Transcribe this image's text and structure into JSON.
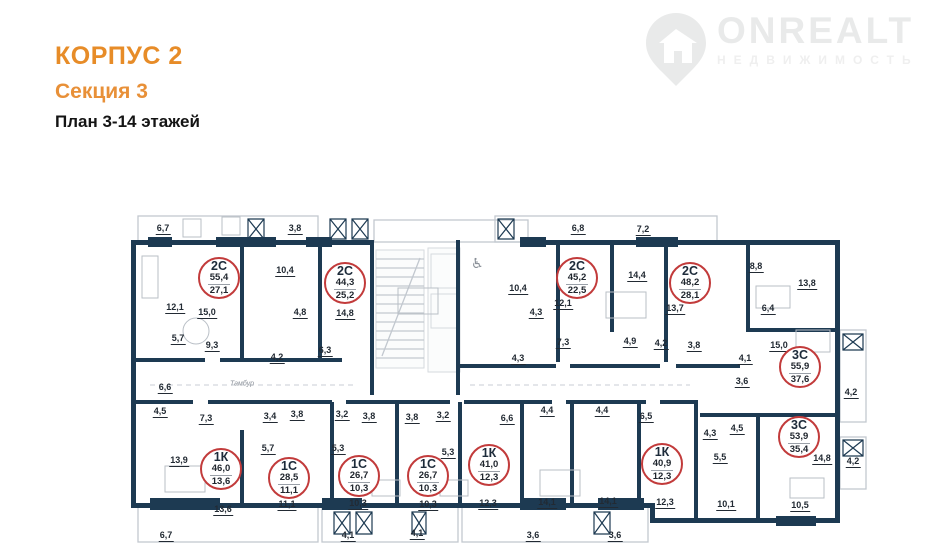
{
  "header": {
    "building": "КОРПУС 2",
    "section": "Секция 3",
    "plan": "План 3-14 этажей"
  },
  "logo": {
    "brand": "ONREALT",
    "tagline": "НЕДВИЖИМОСТЬ"
  },
  "colors": {
    "accent_orange": "#E78C28",
    "wall_navy": "#1D3A52",
    "unit_circle_red": "#C23B3B",
    "watermark_gray": "#E9EAEA"
  },
  "floor_plan": {
    "apartments": [
      {
        "type": "2С",
        "total": "55,4",
        "living": "27,1",
        "x": 219,
        "y": 278
      },
      {
        "type": "2С",
        "total": "44,3",
        "living": "25,2",
        "x": 345,
        "y": 283
      },
      {
        "type": "2С",
        "total": "45,2",
        "living": "22,5",
        "x": 577,
        "y": 278
      },
      {
        "type": "2С",
        "total": "48,2",
        "living": "28,1",
        "x": 690,
        "y": 283
      },
      {
        "type": "3С",
        "total": "55,9",
        "living": "37,6",
        "x": 800,
        "y": 367
      },
      {
        "type": "3С",
        "total": "53,9",
        "living": "35,4",
        "x": 799,
        "y": 437
      },
      {
        "type": "1К",
        "total": "46,0",
        "living": "13,6",
        "x": 221,
        "y": 469
      },
      {
        "type": "1С",
        "total": "28,5",
        "living": "11,1",
        "x": 289,
        "y": 478
      },
      {
        "type": "1С",
        "total": "26,7",
        "living": "10,3",
        "x": 359,
        "y": 476
      },
      {
        "type": "1С",
        "total": "26,7",
        "living": "10,3",
        "x": 428,
        "y": 476
      },
      {
        "type": "1К",
        "total": "41,0",
        "living": "12,3",
        "x": 489,
        "y": 465
      },
      {
        "type": "1К",
        "total": "40,9",
        "living": "12,3",
        "x": 662,
        "y": 464
      }
    ],
    "room_labels": [
      {
        "v": "6,7",
        "x": 163,
        "y": 228
      },
      {
        "v": "3,8",
        "x": 295,
        "y": 228
      },
      {
        "v": "6,8",
        "x": 578,
        "y": 228
      },
      {
        "v": "7,2",
        "x": 643,
        "y": 229
      },
      {
        "v": "10,4",
        "x": 285,
        "y": 270
      },
      {
        "v": "12,1",
        "x": 175,
        "y": 307
      },
      {
        "v": "15,0",
        "x": 207,
        "y": 312
      },
      {
        "v": "4,8",
        "x": 300,
        "y": 312
      },
      {
        "v": "14,8",
        "x": 345,
        "y": 313
      },
      {
        "v": "5,7",
        "x": 178,
        "y": 338
      },
      {
        "v": "9,3",
        "x": 212,
        "y": 345
      },
      {
        "v": "4,2",
        "x": 277,
        "y": 357
      },
      {
        "v": "6,3",
        "x": 325,
        "y": 350
      },
      {
        "v": "6,6",
        "x": 165,
        "y": 387
      },
      {
        "v": "10,4",
        "x": 518,
        "y": 288
      },
      {
        "v": "4,3",
        "x": 536,
        "y": 312
      },
      {
        "v": "4,3",
        "x": 518,
        "y": 358
      },
      {
        "v": "12,1",
        "x": 563,
        "y": 303
      },
      {
        "v": "7,3",
        "x": 563,
        "y": 342
      },
      {
        "v": "14,4",
        "x": 637,
        "y": 275
      },
      {
        "v": "13,7",
        "x": 675,
        "y": 308
      },
      {
        "v": "4,9",
        "x": 630,
        "y": 341
      },
      {
        "v": "4,2",
        "x": 661,
        "y": 343
      },
      {
        "v": "3,8",
        "x": 694,
        "y": 345
      },
      {
        "v": "4,1",
        "x": 745,
        "y": 358
      },
      {
        "v": "3,6",
        "x": 742,
        "y": 381
      },
      {
        "v": "8,8",
        "x": 756,
        "y": 266
      },
      {
        "v": "13,8",
        "x": 807,
        "y": 283
      },
      {
        "v": "6,4",
        "x": 768,
        "y": 308
      },
      {
        "v": "15,0",
        "x": 779,
        "y": 345
      },
      {
        "v": "4,2",
        "x": 851,
        "y": 392
      },
      {
        "v": "4,5",
        "x": 160,
        "y": 411
      },
      {
        "v": "7,3",
        "x": 206,
        "y": 418
      },
      {
        "v": "3,4",
        "x": 270,
        "y": 416
      },
      {
        "v": "3,8",
        "x": 297,
        "y": 414
      },
      {
        "v": "5,7",
        "x": 268,
        "y": 448
      },
      {
        "v": "13,9",
        "x": 179,
        "y": 460
      },
      {
        "v": "13,6",
        "x": 223,
        "y": 509
      },
      {
        "v": "11,1",
        "x": 287,
        "y": 504
      },
      {
        "v": "6,7",
        "x": 166,
        "y": 535
      },
      {
        "v": "3,2",
        "x": 342,
        "y": 414
      },
      {
        "v": "3,8",
        "x": 369,
        "y": 416
      },
      {
        "v": "3,8",
        "x": 412,
        "y": 417
      },
      {
        "v": "3,2",
        "x": 443,
        "y": 415
      },
      {
        "v": "5,3",
        "x": 338,
        "y": 448
      },
      {
        "v": "5,3",
        "x": 448,
        "y": 452
      },
      {
        "v": "10,3",
        "x": 358,
        "y": 503
      },
      {
        "v": "10,3",
        "x": 428,
        "y": 504
      },
      {
        "v": "4,1",
        "x": 348,
        "y": 535
      },
      {
        "v": "4,1",
        "x": 417,
        "y": 533
      },
      {
        "v": "6,6",
        "x": 507,
        "y": 418
      },
      {
        "v": "4,4",
        "x": 547,
        "y": 410
      },
      {
        "v": "4,4",
        "x": 602,
        "y": 410
      },
      {
        "v": "6,5",
        "x": 646,
        "y": 416
      },
      {
        "v": "12,3",
        "x": 488,
        "y": 503
      },
      {
        "v": "14,1",
        "x": 547,
        "y": 502
      },
      {
        "v": "14,1",
        "x": 608,
        "y": 501
      },
      {
        "v": "3,6",
        "x": 533,
        "y": 535
      },
      {
        "v": "3,6",
        "x": 615,
        "y": 535
      },
      {
        "v": "4,3",
        "x": 710,
        "y": 433
      },
      {
        "v": "4,5",
        "x": 737,
        "y": 428
      },
      {
        "v": "5,5",
        "x": 720,
        "y": 457
      },
      {
        "v": "12,3",
        "x": 665,
        "y": 502
      },
      {
        "v": "10,1",
        "x": 726,
        "y": 504
      },
      {
        "v": "14,8",
        "x": 822,
        "y": 458
      },
      {
        "v": "10,5",
        "x": 800,
        "y": 505
      },
      {
        "v": "4,2",
        "x": 853,
        "y": 461
      }
    ],
    "annotations": [
      {
        "text": "Тамбур",
        "x": 242,
        "y": 384
      }
    ]
  }
}
